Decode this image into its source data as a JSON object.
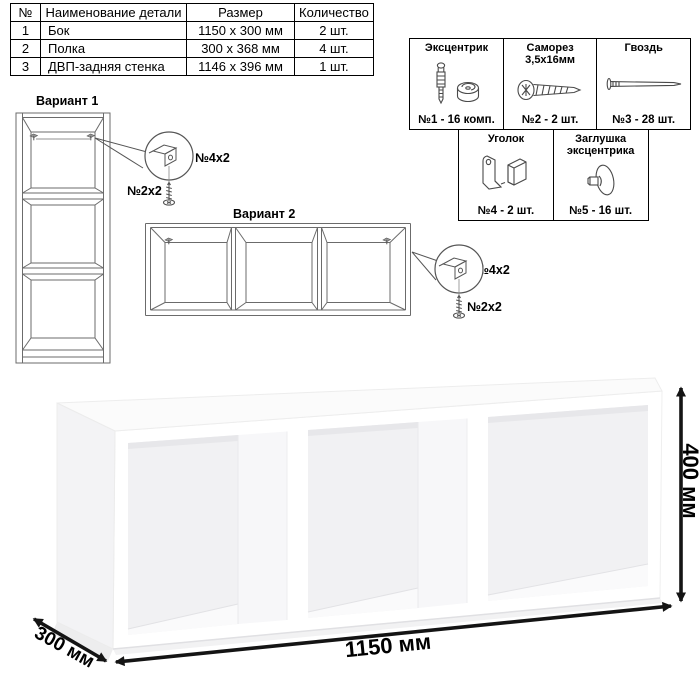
{
  "parts_table": {
    "headers": {
      "num": "№",
      "name": "Наименование детали",
      "size": "Размер",
      "qty": "Количество"
    },
    "rows": [
      {
        "num": "1",
        "name": "Бок",
        "size": "1150 х 300 мм",
        "qty": "2 шт."
      },
      {
        "num": "2",
        "name": "Полка",
        "size": "300 х 368 мм",
        "qty": "4 шт."
      },
      {
        "num": "3",
        "name": "ДВП-задняя стенка",
        "size": "1146 х 396 мм",
        "qty": "1 шт."
      }
    ]
  },
  "hardware": {
    "items": [
      {
        "title": "Эксцентрик",
        "subtitle": "",
        "label": "№1 - 16 комп.",
        "icon": "cam-and-dowel-icon"
      },
      {
        "title": "Саморез",
        "subtitle": "3,5х16мм",
        "label": "№2 - 2 шт.",
        "icon": "screw-icon"
      },
      {
        "title": "Гвоздь",
        "subtitle": "",
        "label": "№3 - 28 шт.",
        "icon": "nail-icon"
      },
      {
        "title": "Уголок",
        "subtitle": "",
        "label": "№4 - 2 шт.",
        "icon": "corner-bracket-icon"
      },
      {
        "title": "Заглушка",
        "subtitle": "эксцентрика",
        "label": "№5 - 16 шт.",
        "icon": "cam-cap-icon"
      }
    ]
  },
  "variants": {
    "v1": {
      "title": "Вариант 1",
      "bracket_label": "№4х2",
      "screw_label": "№2х2"
    },
    "v2": {
      "title": "Вариант 2",
      "bracket_label": "№4х2",
      "screw_label": "№2х2"
    }
  },
  "render": {
    "width_label": "1150 мм",
    "height_label": "400 мм",
    "depth_label": "300 мм"
  },
  "colors": {
    "drawing_line": "#6b6b6b",
    "dimension": "#141414",
    "interior_shade": "#f1f1f3",
    "table_border": "#000000"
  }
}
